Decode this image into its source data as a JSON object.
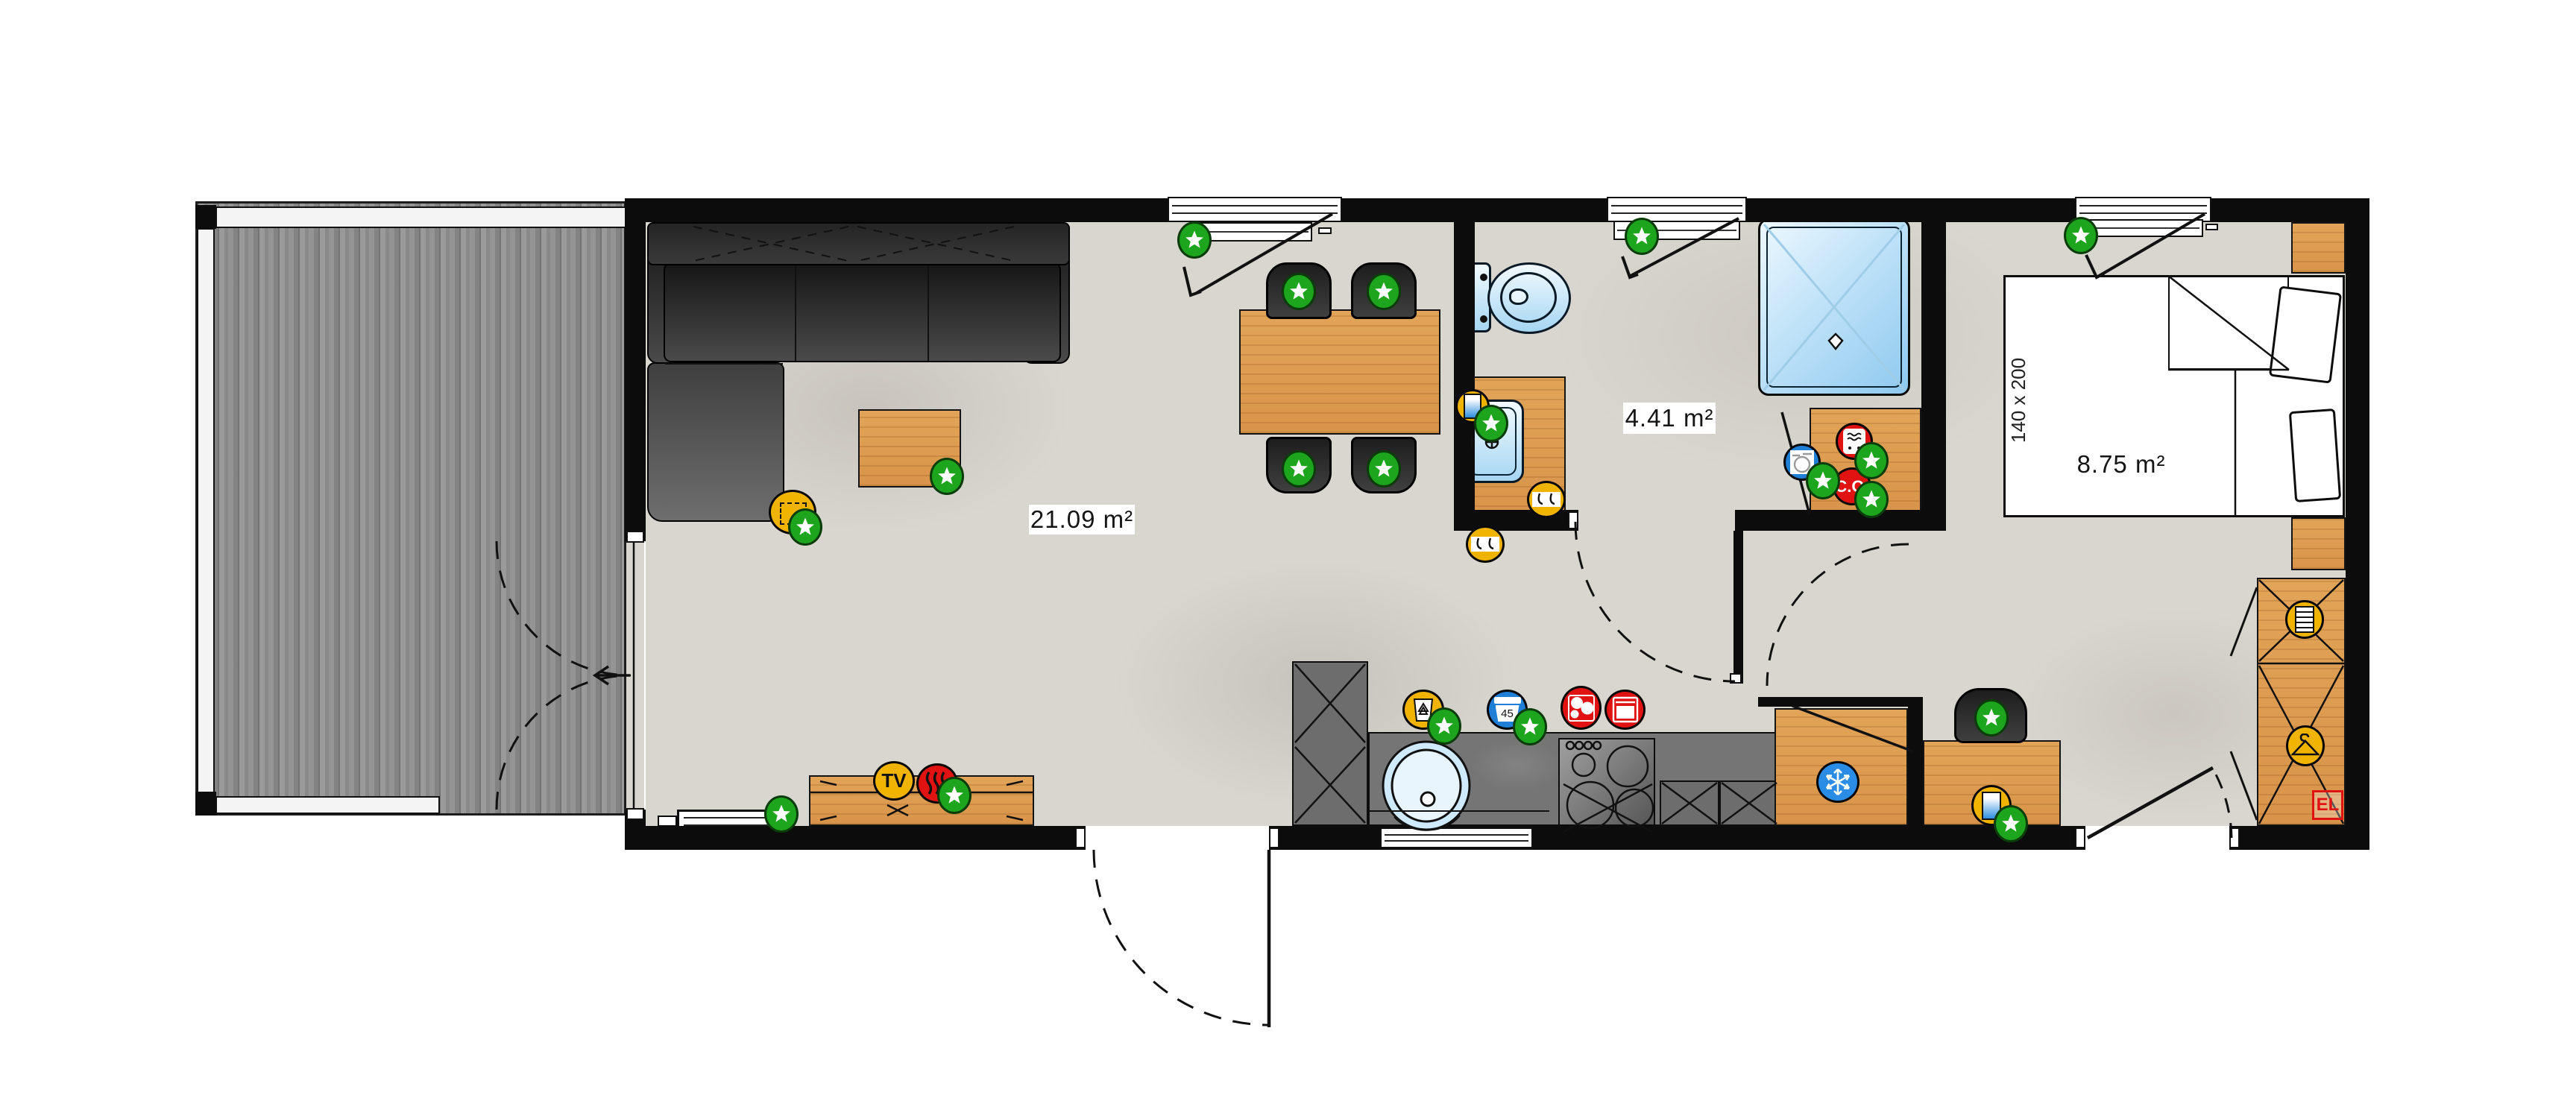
{
  "document": {
    "type": "floor-plan"
  },
  "rooms": {
    "living_room": {
      "area_label": "21.09 m²"
    },
    "bathroom": {
      "area_label": "4.41 m²"
    },
    "bedroom": {
      "area_label": "8.75 m²",
      "bed_size_label": "140 x 200"
    }
  },
  "badges": {
    "tv_label": "TV",
    "co_detector_label": "C.O.",
    "waste_bin_label": "45",
    "electric_panel_label": "EL"
  },
  "legend_icons": [
    "approved-star-icon",
    "tv-icon",
    "heat-source-icon",
    "recycle-bin-icon",
    "waste-bin-45-icon",
    "hob-icon",
    "oven-icon",
    "water-heater-icon",
    "washing-machine-icon",
    "co-detector-icon",
    "fridge-snowflake-icon",
    "towel-hooks-icon",
    "boiler-icon",
    "drawers-icon",
    "hanger-icon",
    "electric-panel-icon"
  ],
  "colors": {
    "wall": "#0c0c0c",
    "wood": "#e0a155",
    "deck_wood": "#8e8e8e",
    "concrete_floor": "#d9d6d0",
    "counter": "#757575",
    "accent_green": "#1ea51e",
    "accent_yellow": "#f0b400",
    "accent_red": "#e01212",
    "accent_blue": "#1f7fd6",
    "fixture_blue": "#cfeafc"
  }
}
